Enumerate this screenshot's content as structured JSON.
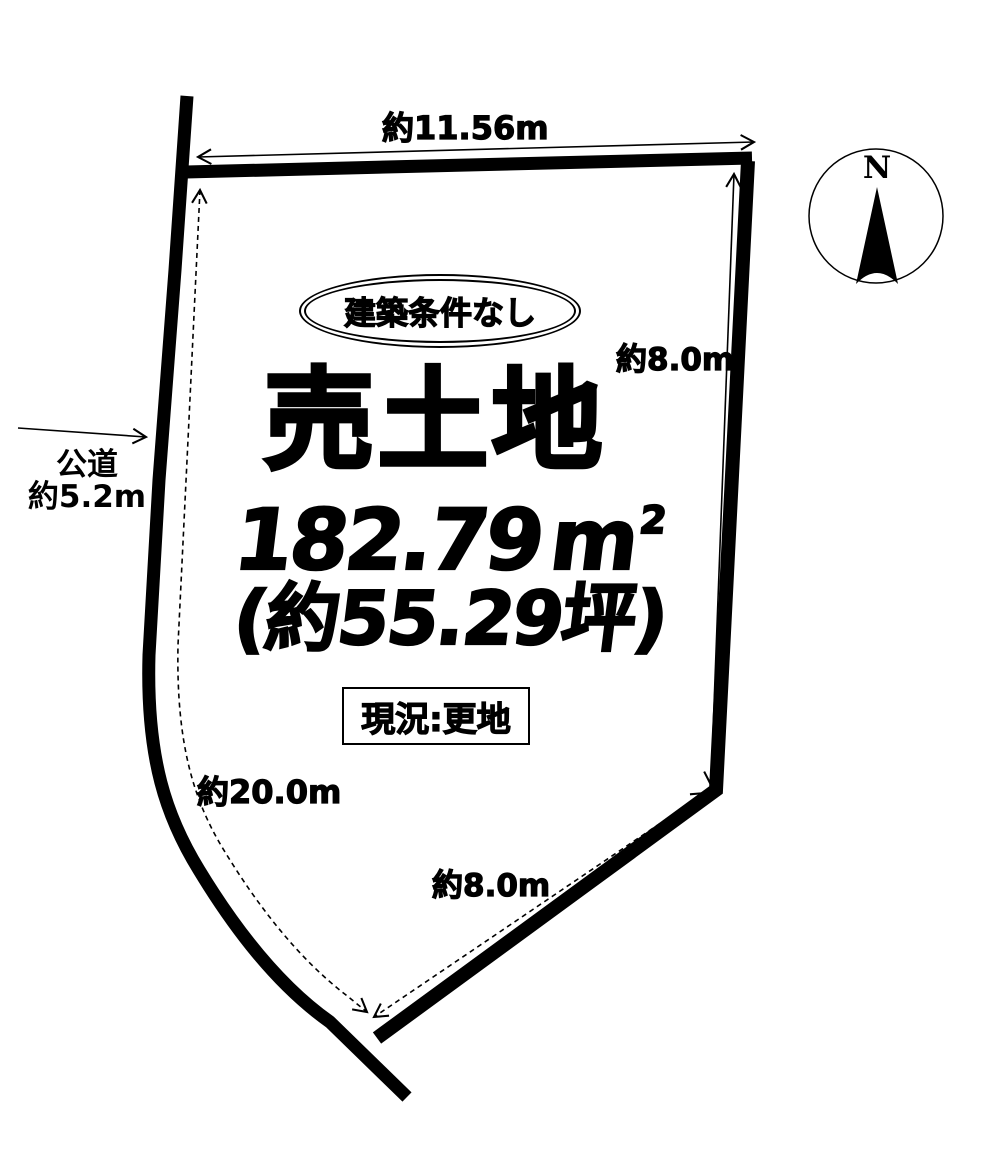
{
  "page": {
    "bg_color": "#ffffff",
    "ink_color": "#000000"
  },
  "parcel": {
    "badge_label": "建築条件なし",
    "title": "売土地",
    "area_value": "182.79",
    "area_unit": "m",
    "area_exponent": "2",
    "area_tsubo": "(約55.29坪)",
    "status_label": "現況:更地"
  },
  "dimensions": {
    "top_edge": "約11.56m",
    "right_edge": "約8.0m",
    "bottom_edge": "約8.0m",
    "left_edge": "約20.0m"
  },
  "road": {
    "name": "公道",
    "width": "約5.2m"
  },
  "compass": {
    "north_label": "N"
  }
}
